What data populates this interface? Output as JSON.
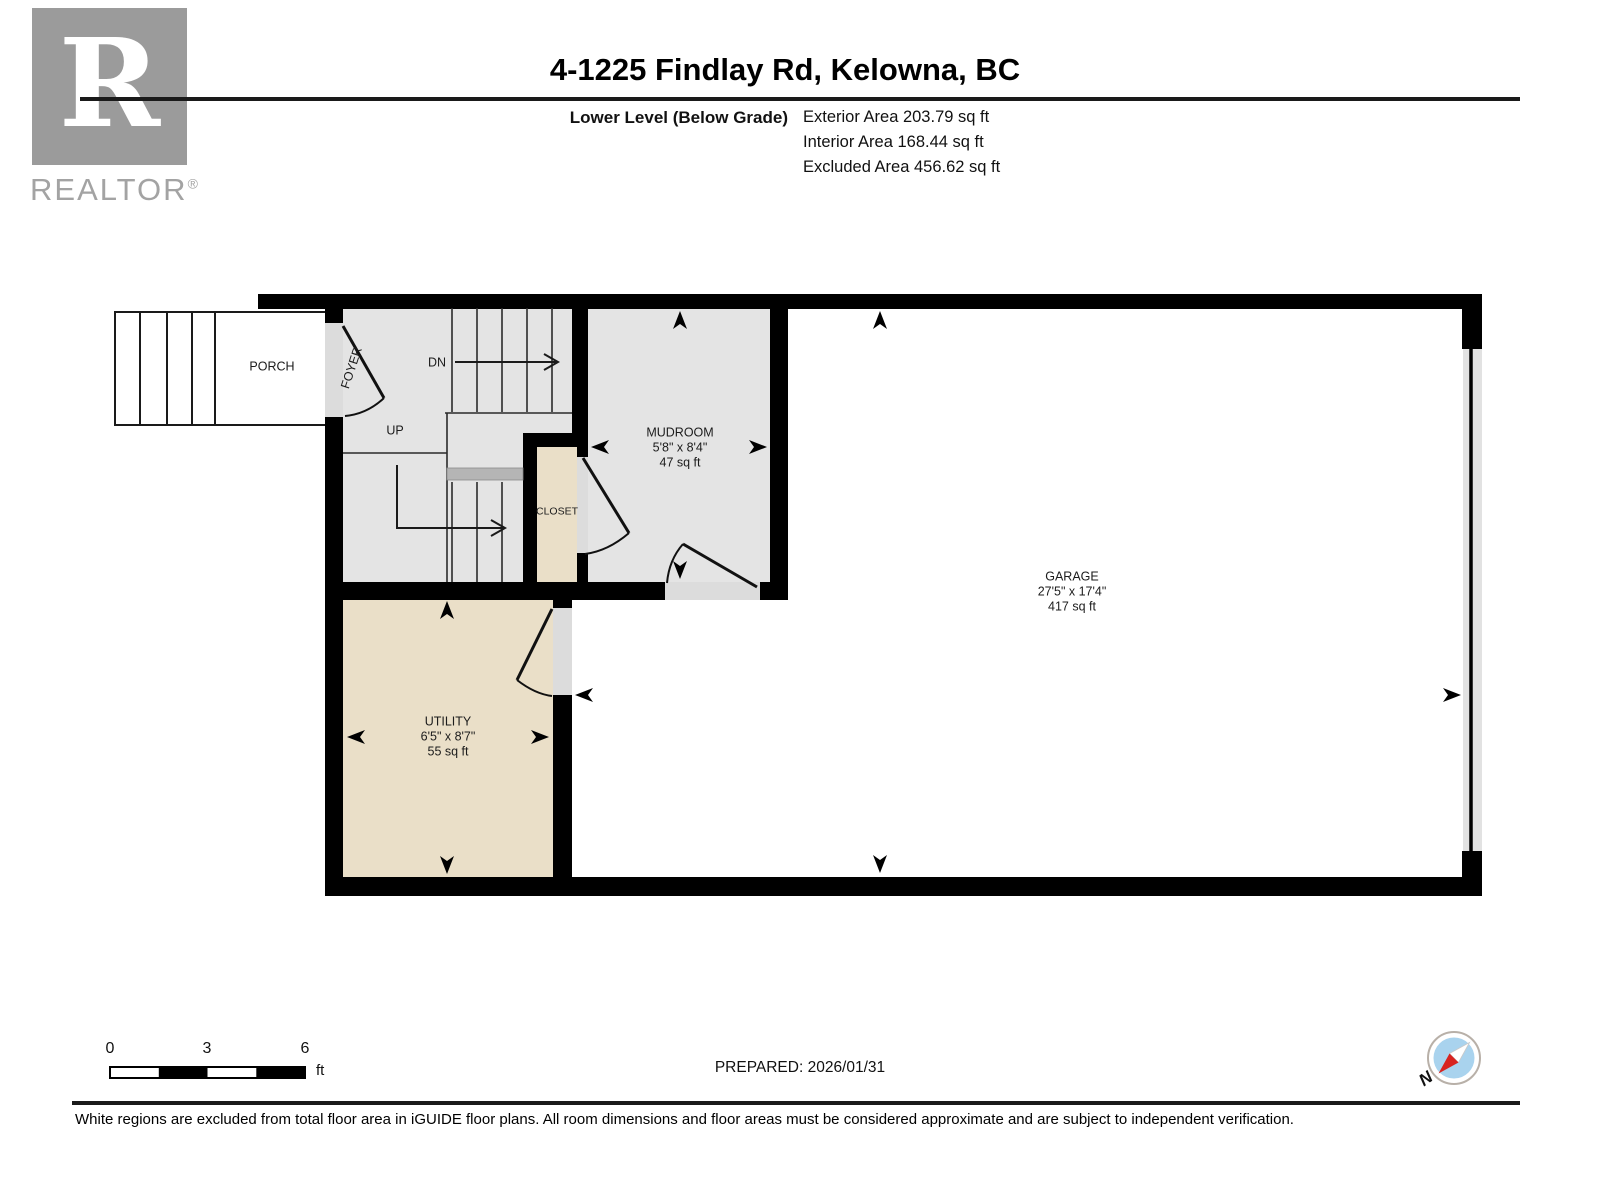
{
  "header": {
    "title": "4-1225 Findlay Rd, Kelowna, BC",
    "level": "Lower Level (Below Grade)",
    "areas": {
      "exterior": "Exterior Area 203.79 sq ft",
      "interior": "Interior Area 168.44 sq ft",
      "excluded": "Excluded Area 456.62 sq ft"
    },
    "logo_letter": "R",
    "logo_text": "REALTOR",
    "logo_reg": "®"
  },
  "plan": {
    "rooms": {
      "porch": {
        "name": "PORCH"
      },
      "foyer": {
        "name": "FOYER"
      },
      "mudroom": {
        "name": "MUDROOM",
        "dims": "5'8\" x 8'4\"",
        "area": "47 sq ft"
      },
      "closet": {
        "name": "CLOSET"
      },
      "utility": {
        "name": "UTILITY",
        "dims": "6'5\" x 8'7\"",
        "area": "55 sq ft"
      },
      "garage": {
        "name": "GARAGE",
        "dims": "27'5\" x 17'4\"",
        "area": "417 sq ft"
      }
    },
    "stairs": {
      "up": "UP",
      "down": "DN"
    },
    "colors": {
      "wall": "#000000",
      "interior_gray": "#e4e4e4",
      "room_beige": "#eadfc8",
      "threshold_gray": "#dcdcdc",
      "landing_gray": "#b5b5b5",
      "compass_blue": "#a9d3ee",
      "compass_red": "#d8231f"
    }
  },
  "footer": {
    "scale": {
      "t0": "0",
      "t3": "3",
      "t6": "6",
      "unit": "ft"
    },
    "prepared": "PREPARED: 2026/01/31",
    "compass_north": "N",
    "disclaimer": "White regions are excluded from total floor area in iGUIDE floor plans. All room dimensions and floor areas must be considered approximate and are subject to independent verification."
  }
}
